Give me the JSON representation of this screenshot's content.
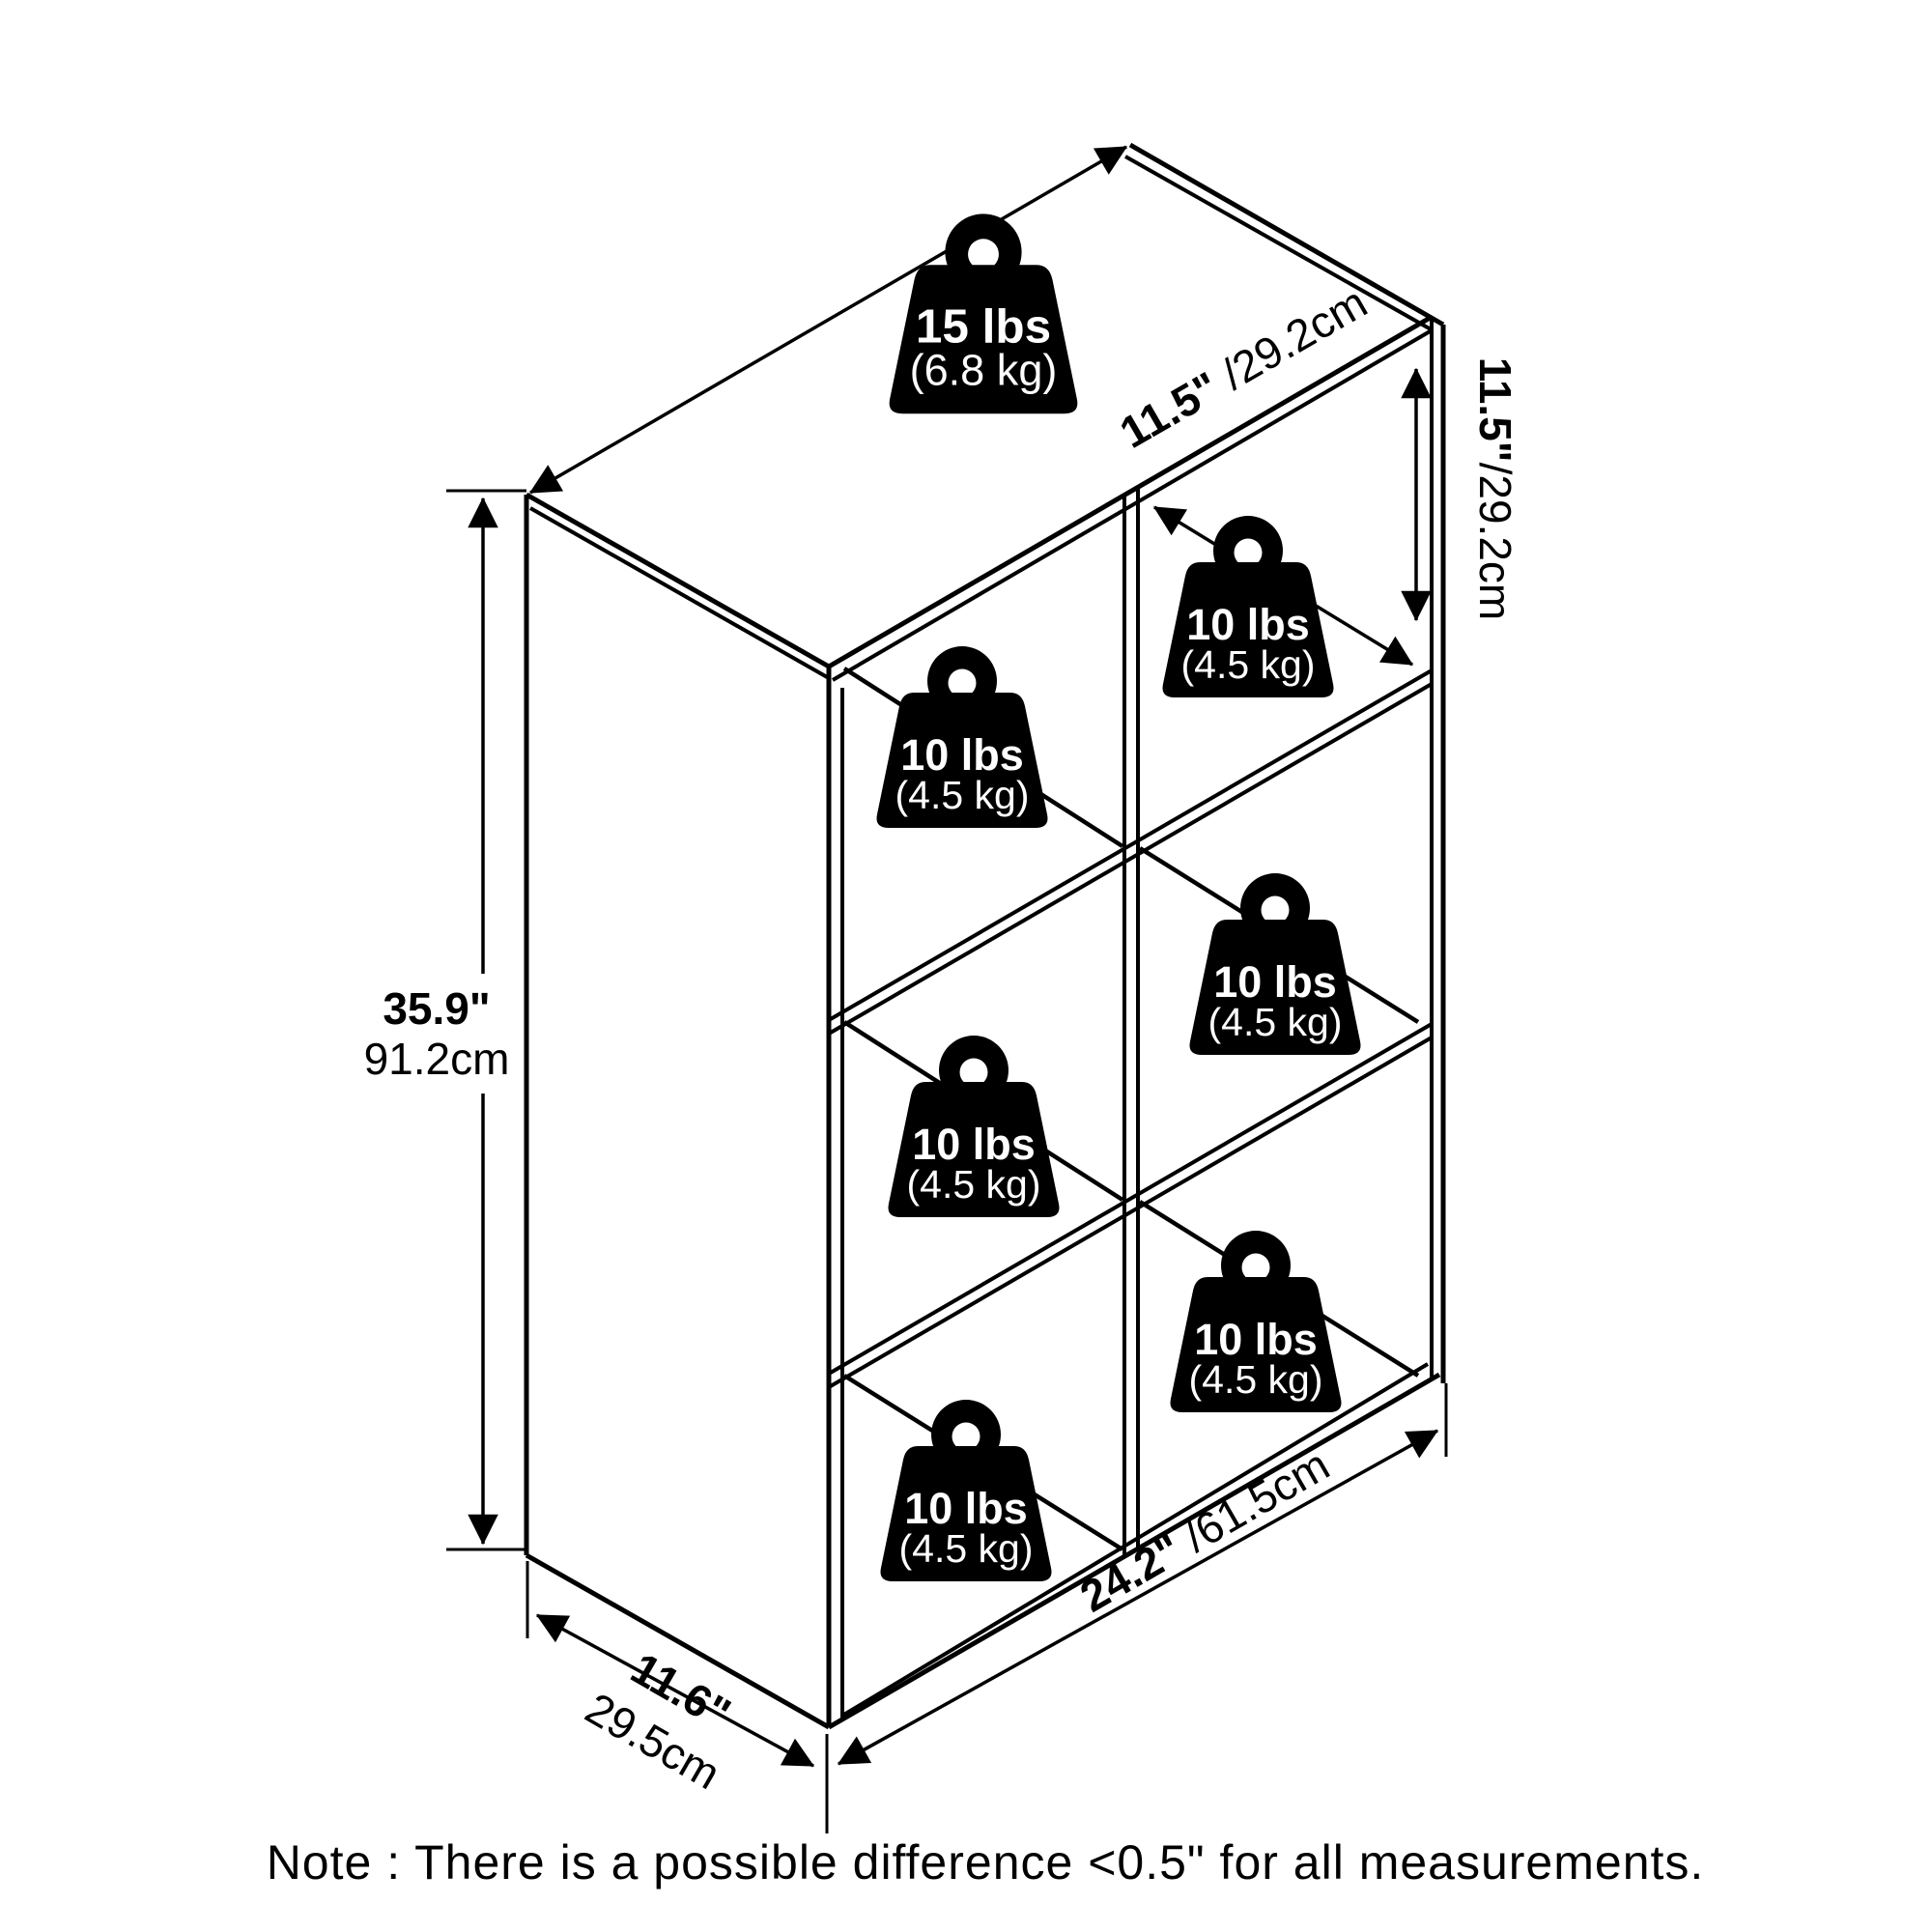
{
  "diagram": {
    "title": "6-cube storage shelf dimension diagram",
    "background_color": "#ffffff",
    "line_color": "#000000",
    "note": "Note : There is a possible difference <0.5\" for all measurements.",
    "weights": {
      "top": {
        "value": "15 lbs",
        "metric": "(6.8 kg)"
      },
      "cube": {
        "value": "10 lbs",
        "metric": "(4.5 kg)"
      }
    },
    "dimensions": {
      "height": {
        "imperial": "35.9\"",
        "metric": "91.2cm"
      },
      "top_depth": {
        "imperial": "11.5\"",
        "metric": " /29.2cm"
      },
      "cube_height": {
        "imperial": "11.5\"",
        "metric": "/29.2cm"
      },
      "width": {
        "imperial": "24.2\"",
        "metric": " /61.5cm"
      },
      "base_depth": {
        "imperial": "11.6\"",
        "metric": "29.5cm"
      }
    }
  }
}
